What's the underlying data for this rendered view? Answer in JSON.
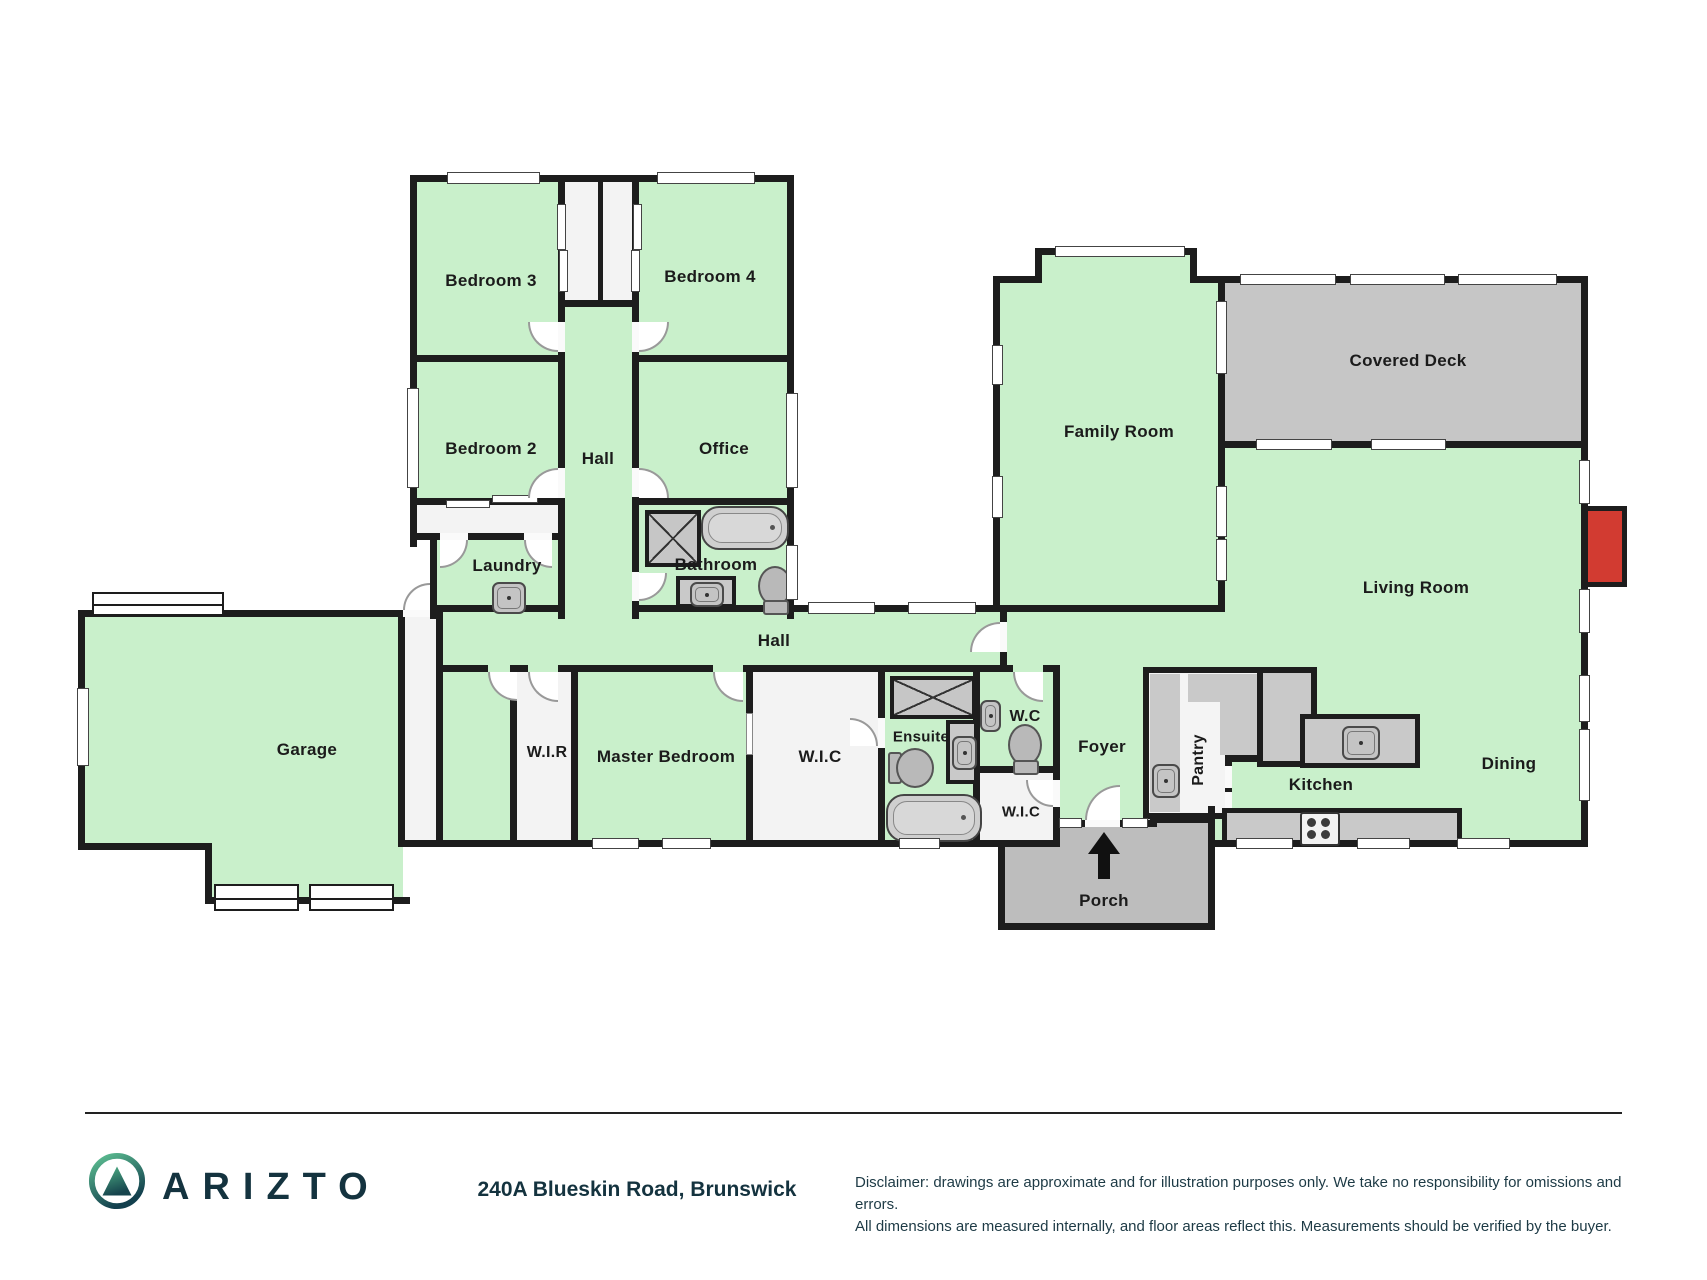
{
  "plan": {
    "rooms": {
      "bedroom3": "Bedroom 3",
      "bedroom4": "Bedroom 4",
      "bedroom2": "Bedroom 2",
      "office": "Office",
      "hall_north": "Hall",
      "laundry": "Laundry",
      "bathroom": "Bathroom",
      "hall_main": "Hall",
      "garage": "Garage",
      "wir": "W.I.R",
      "master_bedroom": "Master Bedroom",
      "wic": "W.I.C",
      "ensuite": "Ensuite",
      "wc": "W.C",
      "wic2": "W.I.C",
      "foyer": "Foyer",
      "pantry": "Pantry",
      "kitchen": "Kitchen",
      "dining": "Dining",
      "living_room": "Living Room",
      "family_room": "Family Room",
      "covered_deck": "Covered Deck",
      "porch": "Porch"
    },
    "colors": {
      "floor_green": "#c9f0cb",
      "deck_gray": "#c6c6c6",
      "porch_gray": "#bdbdbd",
      "wall": "#1d1d1d",
      "fireplace_red": "#d23b31"
    }
  },
  "footer": {
    "brand": "ARIZTO",
    "logo_icon": "mountain-in-circle",
    "address": "240A Blueskin Road, Brunswick",
    "disclaimer_line1": "Disclaimer: drawings are approximate and for illustration purposes only. We take no responsibility for omissions and errors.",
    "disclaimer_line2": "All dimensions are measured internally, and floor areas reflect this. Measurements should be verified by the buyer."
  }
}
